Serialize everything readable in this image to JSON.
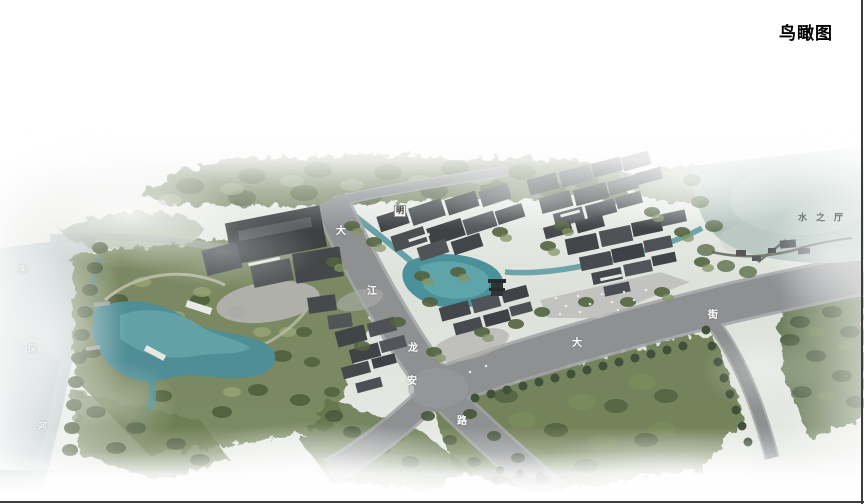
{
  "title": "鸟瞰图",
  "scene": {
    "road_labels": [
      {
        "text": "大",
        "x": 341,
        "y": 232
      },
      {
        "text": "江",
        "x": 372,
        "y": 292
      },
      {
        "text": "龙",
        "x": 413,
        "y": 349
      },
      {
        "text": "安",
        "x": 412,
        "y": 382
      },
      {
        "text": "路",
        "x": 462,
        "y": 422
      },
      {
        "text": "大",
        "x": 577,
        "y": 344
      },
      {
        "text": "街",
        "x": 713,
        "y": 316
      }
    ],
    "river_labels": [
      {
        "text": "朱",
        "x": 23,
        "y": 271
      },
      {
        "text": "保",
        "x": 32,
        "y": 350
      },
      {
        "text": "河",
        "x": 42,
        "y": 428
      }
    ],
    "area_labels": [
      {
        "text": "水之厅",
        "x": 825,
        "y": 219
      }
    ],
    "marker_labels": [
      {
        "text": "明",
        "x": 400,
        "y": 211
      }
    ]
  },
  "palette": {
    "road_gray": "#8e9092",
    "water_teal": "#4f939a",
    "lake_pale": "#b2c3be",
    "tree_green": "#6b7b52",
    "title_color": "#000000",
    "road_label_color": "#ffffff",
    "area_label_color": "#6f7a76"
  }
}
